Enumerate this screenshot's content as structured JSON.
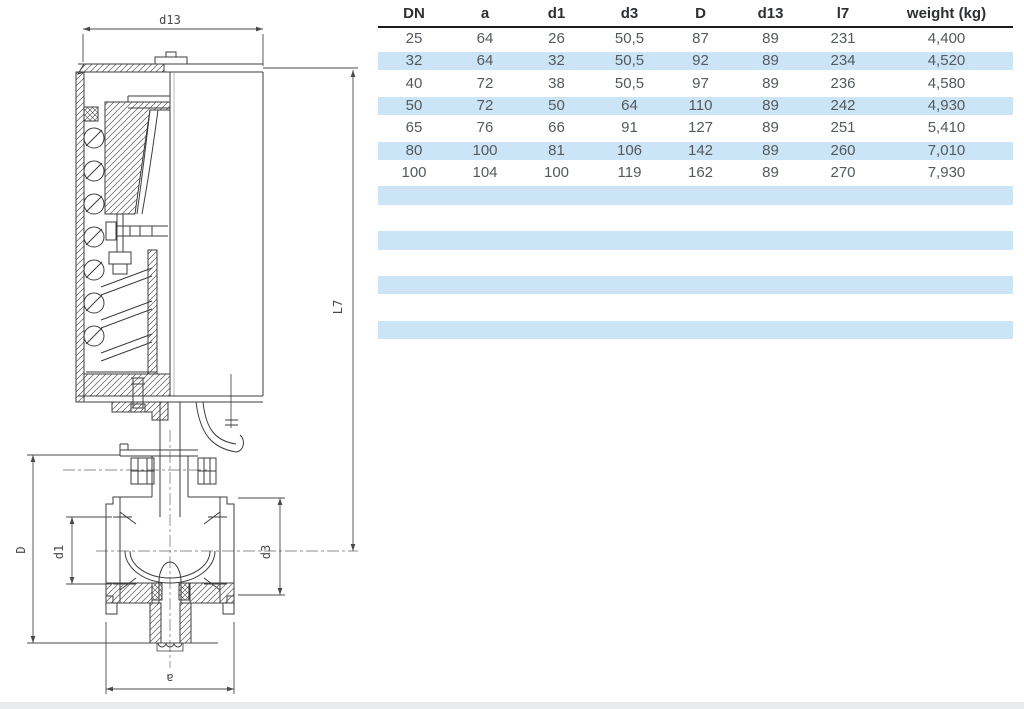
{
  "table": {
    "columns": [
      "DN",
      "a",
      "d1",
      "d3",
      "D",
      "d13",
      "l7",
      "weight (kg)"
    ],
    "rows": [
      [
        "25",
        "64",
        "26",
        "50,5",
        "87",
        "89",
        "231",
        "4,400"
      ],
      [
        "32",
        "64",
        "32",
        "50,5",
        "92",
        "89",
        "234",
        "4,520"
      ],
      [
        "40",
        "72",
        "38",
        "50,5",
        "97",
        "89",
        "236",
        "4,580"
      ],
      [
        "50",
        "72",
        "50",
        "64",
        "110",
        "89",
        "242",
        "4,930"
      ],
      [
        "65",
        "76",
        "66",
        "91",
        "127",
        "89",
        "251",
        "5,410"
      ],
      [
        "80",
        "100",
        "81",
        "106",
        "142",
        "89",
        "260",
        "7,010"
      ],
      [
        "100",
        "104",
        "100",
        "119",
        "162",
        "89",
        "270",
        "7,930"
      ]
    ],
    "empty_row_count": 7,
    "stripe_color": "#cbe5f6",
    "header_rule_color": "#1b1b1b",
    "text_color": "#54595e"
  },
  "drawing": {
    "labels": {
      "top_width": "d13",
      "height": "L7",
      "body_height": "D",
      "bore": "d1",
      "seat": "d3",
      "port_width": "a"
    },
    "line_color": "#3c3c3c",
    "dim_color": "#4a4a4a"
  },
  "footer": {
    "bar_color": "#e9eaec"
  }
}
